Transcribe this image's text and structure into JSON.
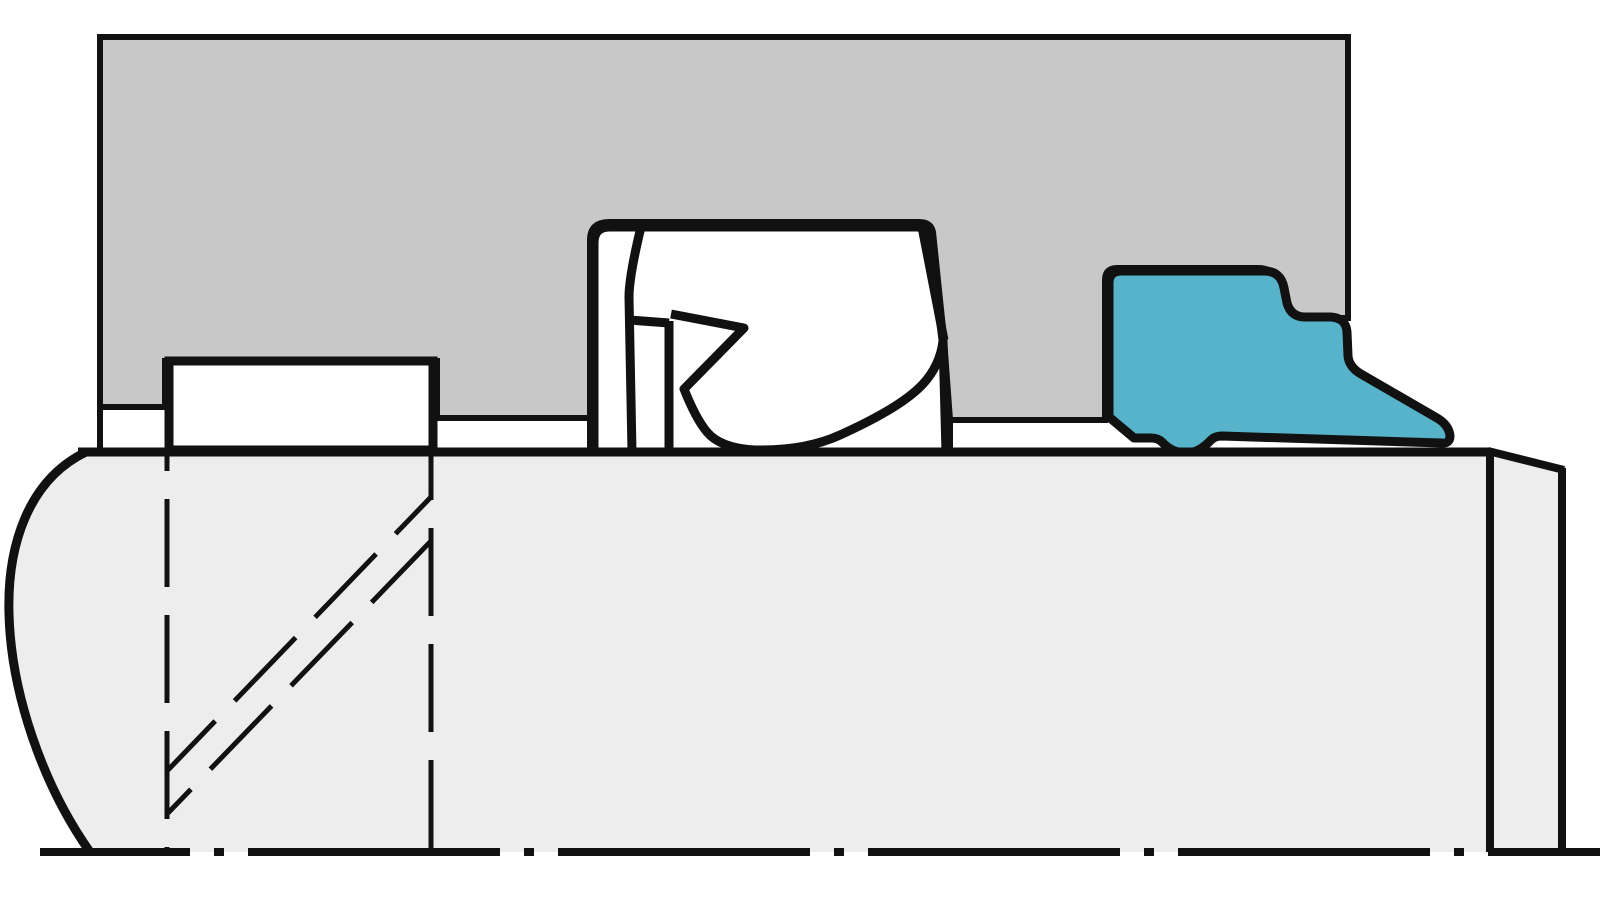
{
  "diagram": {
    "kind": "technical-cross-section",
    "parts": {
      "housing": "Housing gland cross-section",
      "rod": "Piston rod cross-section",
      "guide_ring": "Guide ring in housing recess",
      "rod_seal": "Rod seal with back-up ring in groove",
      "wiper_seal": "Wiper seal with protruding lip",
      "centerline": "Rod centerline (dash-dot)",
      "projection_lines": "Dashed projection lines of guide ring",
      "section_diagonals": "Dashed diagonal section lines"
    }
  },
  "colors": {
    "background": "#ffffff",
    "housing_fill": "#c8c8c8",
    "rod_fill": "#ededee",
    "seal_fill": "#ffffff",
    "wiper_fill": "#57b3c9",
    "line_color": "#111111"
  }
}
